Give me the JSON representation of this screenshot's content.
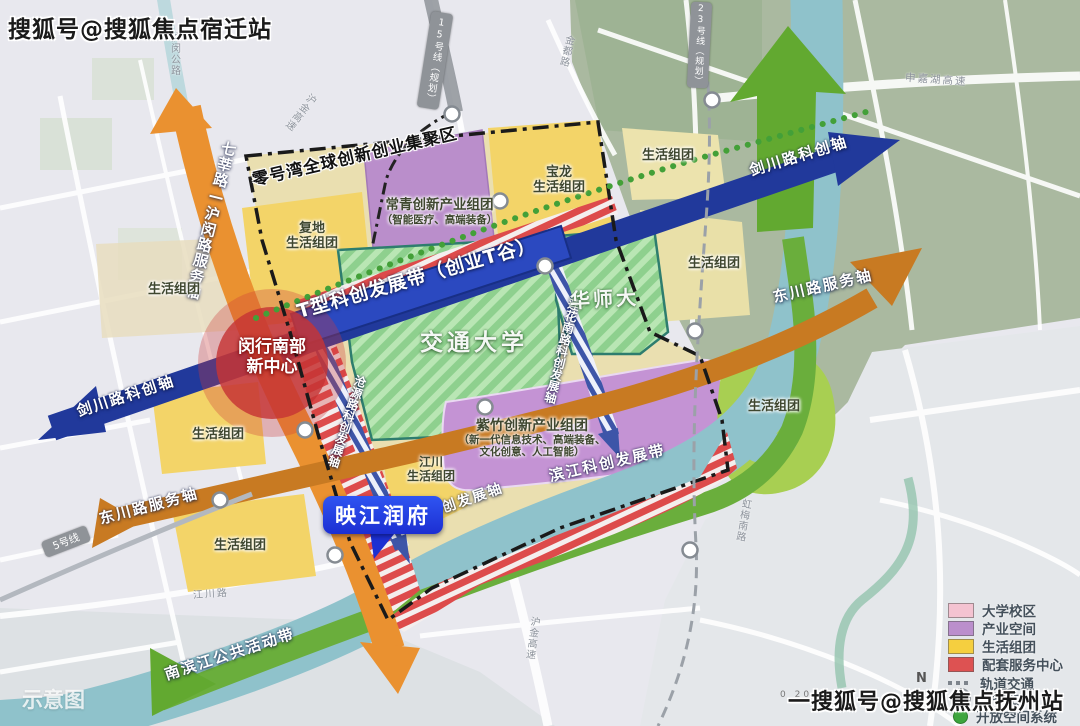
{
  "watermarks": {
    "top_left": "搜狐号@搜狐焦点宿迁站",
    "bottom_right": "一搜狐号@搜狐焦点抚州站",
    "bottom_left": "示意图"
  },
  "axes": {
    "qixin_humin": "七莘路—沪闵路服务轴",
    "jianchuan_left": "剑川路科创轴",
    "jianchuan_right": "剑川路科创轴",
    "t_valley_belt": "T型科创发展带（创业T谷）",
    "lianhua_axis": "莲花南路科创发展轴",
    "cangyuan_axis": "沧源路科创发展轴",
    "dongchuan_left": "东川路服务轴",
    "dongchuan_right": "东川路服务轴",
    "binjiang_axis": "滨江科创发展轴",
    "binjiang_belt": "滨江科创发展带",
    "south_riverfront_belt": "南滨江公共活动带",
    "zero_bay_zone": "零号湾全球创新创业集聚区"
  },
  "markers": {
    "new_center_line1": "闵行南部",
    "new_center_line2": "新中心",
    "project_name": "映江润府"
  },
  "zones": {
    "fudi_line1": "复地",
    "fudi_line2": "生活组团",
    "changqing": "常青创新产业组团",
    "changqing_sub": "（智能医疗、高端装备）",
    "baolong_line1": "宝龙",
    "baolong_line2": "生活组团",
    "living_ne": "生活组团",
    "living_east_upper": "生活组团",
    "living_east_lower": "生活组团",
    "living_west": "生活组团",
    "living_southwest": "生活组团",
    "living_south": "生活组团",
    "jiangchuan_line1": "江川",
    "jiangchuan_line2": "生活组团",
    "zizhu": "紫竹创新产业组团",
    "zizhu_sub1": "（新一代信息技术、高端装备、",
    "zizhu_sub2": "文化创意、人工智能）",
    "jiaotong_univ": "交通大学",
    "huashida": "华师大"
  },
  "roads": {
    "shenjiahu": "申嘉湖高速",
    "hujin_north": "沪金高速",
    "humin_highway": "沪闵公路",
    "jindu": "金都路",
    "hongmei_south": "虹梅南路",
    "jiangchuan_road": "江川路",
    "hujin_south": "沪金高速"
  },
  "transit": {
    "line5": "5号线",
    "line15": "15号线（规划）",
    "line23": "23号线（规划）"
  },
  "legend": {
    "items": [
      {
        "label": "大学校区",
        "color": "#f4c3d1"
      },
      {
        "label": "产业空间",
        "color": "#bb8fcc"
      },
      {
        "label": "生活组团",
        "color": "#f5cf3f"
      },
      {
        "label": "配套服务中心",
        "color": "#dd5252"
      },
      {
        "label": "轨道交通",
        "color": "#8a9097"
      },
      {
        "label": "地铁站",
        "color": "#ffffff"
      },
      {
        "label": "开放空间系统",
        "color": "#3da53d"
      }
    ]
  },
  "map_info": {
    "compass": "N",
    "scale_text": "0    200"
  }
}
